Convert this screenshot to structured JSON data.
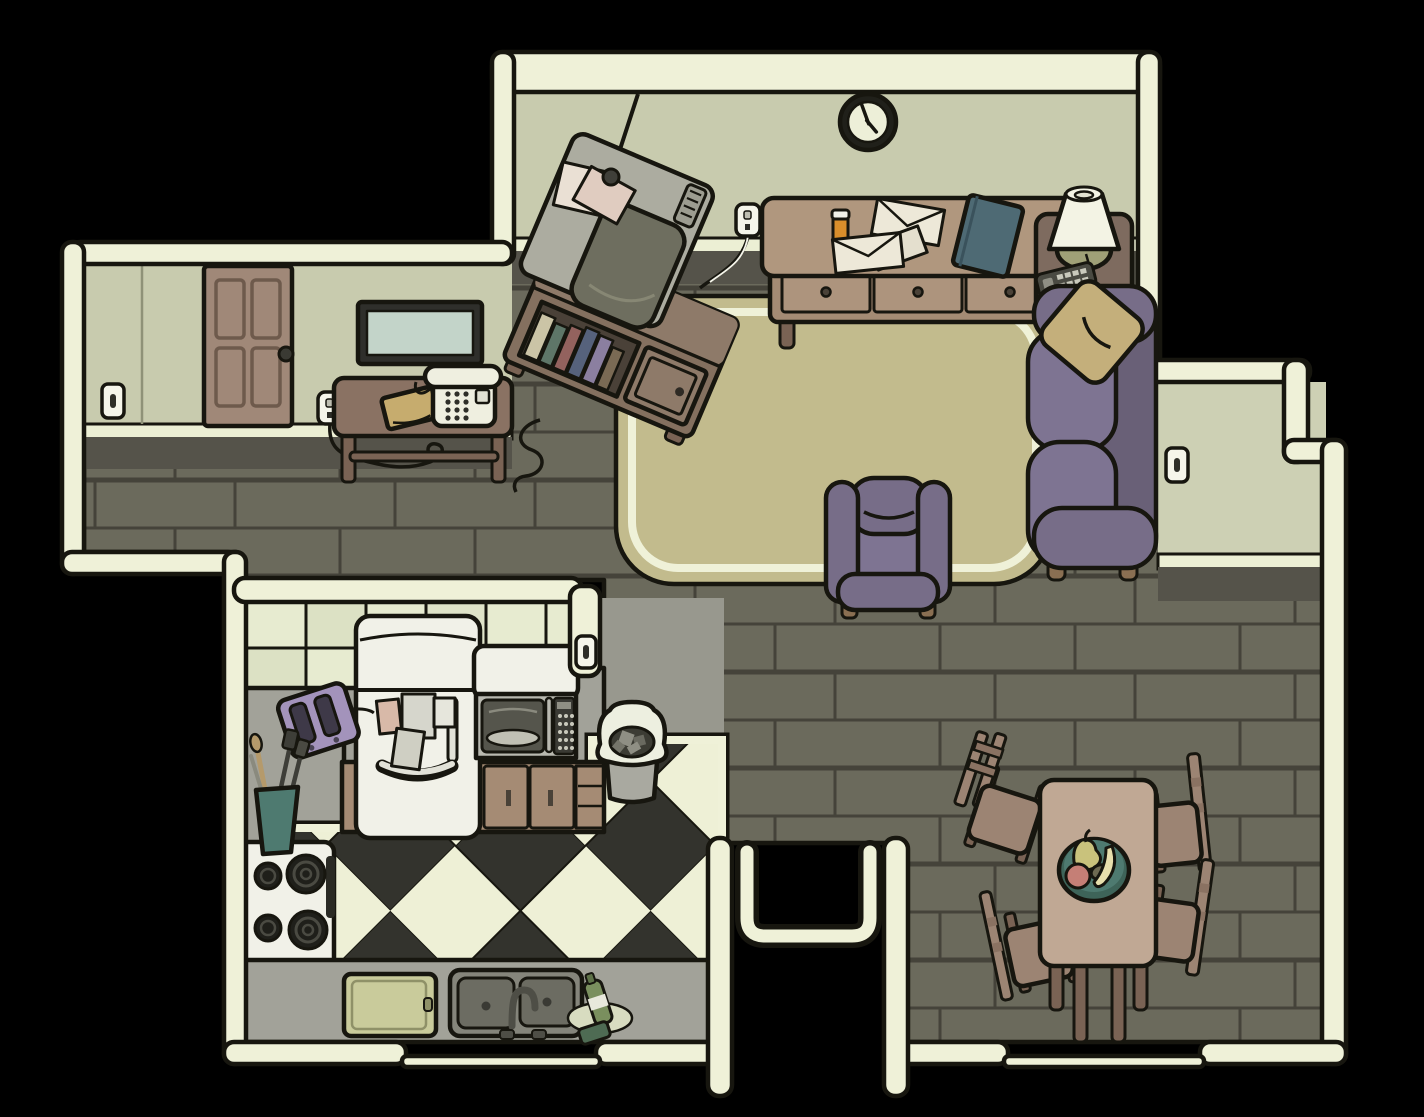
{
  "scene": {
    "title": "Top-down apartment scene",
    "style": "hand-drawn cartoon adventure game",
    "rooms": [
      "living room",
      "hallway",
      "kitchen",
      "dining room"
    ]
  },
  "palette": {
    "background": "#000000",
    "ink": "#17160f",
    "wall_cream": "#EFF1D8",
    "wall_face": "#C8CBAE",
    "wall_face_light": "#CDD0B4",
    "baseboard": "#ECEFD4",
    "shadow_band": "#55534A",
    "wood_floor": "#6B6A5C",
    "plank_line": "#45433A",
    "rug": "#C2BB8D",
    "sofa_purple": "#776D88",
    "sofa_purple_dark": "#696077",
    "sofa_purple_light": "#7E7492",
    "pillow_tan": "#C4AF7B",
    "furniture_brown": "#8A7263",
    "furniture_brown_dark": "#7A6354",
    "sideboard_tan": "#B0977E",
    "tv_gray": "#ACACA0",
    "tv_screen": "#6E6E5F",
    "door_brown": "#A08878",
    "mirror_glass": "#C3D4C9",
    "tile_cream": "#E7EBD0",
    "counter_gray": "#A2A299",
    "appliance_white": "#F1F1E8",
    "cabinet_brown": "#A58B74",
    "checker_dark": "#33332D",
    "checker_light": "#EEF0D6",
    "toaster_purple": "#A393BB",
    "bowl_teal": "#4E7A70",
    "lamp_olive": "#9FA077",
    "book_teal": "#4E6A74",
    "book_tan": "#C6AC6E",
    "pill_orange": "#D98E2B"
  },
  "clock": {
    "time_shown": "approx 4:55",
    "minute_hand_angle_deg": -20,
    "hour_hand_angle_deg": 140
  },
  "objects": {
    "scene_floor": "Wood plank floor",
    "rug": "Living room area rug",
    "clock": "Wall clock",
    "tv": "CRT television",
    "tv_antenna": "TV antenna",
    "tv_papers": "Papers on TV",
    "tv_stand": "TV stand with books",
    "sideboard": "Sideboard with three drawers",
    "pill_bottle": "Pill bottle",
    "envelopes": "Envelopes",
    "blue_book": "Teal book",
    "outlet_tv": "Power outlet",
    "outlet_lamp": "Power outlet",
    "outlet_phone": "Power outlet",
    "side_table": "Side table",
    "lamp": "Table lamp",
    "remote": "TV remote control",
    "sofa": "Purple sofa",
    "pillow": "Throw pillow",
    "armchair": "Purple armchair",
    "door": "Apartment door",
    "mirror": "Wall mirror",
    "light_switch_hall": "Light switch",
    "light_switch_wall": "Light switch",
    "light_switch_kitchen": "Light switch",
    "phone_table": "Telephone table",
    "phone": "Telephone",
    "tan_book": "Book",
    "kitchen_tiles": "Tile backsplash",
    "fridge": "Refrigerator",
    "fridge_notes": "Notes on fridge",
    "microwave": "Microwave oven",
    "toaster": "Toaster",
    "utensils": "Utensil cup",
    "stove": "Electric stove top",
    "cabinets": "Kitchen cabinets",
    "counter": "Kitchen counter",
    "trash": "Trash can",
    "sink": "Double kitchen sink",
    "cutting_board": "Cutting board",
    "soap": "Dish soap and sponge",
    "checker_floor": "Checkered kitchen floor",
    "dining_table": "Dining table",
    "fruit_bowl": "Fruit bowl",
    "chair_1": "Dining chair",
    "chair_2": "Dining chair",
    "chair_3": "Dining chair",
    "chair_4": "Dining chair",
    "passage": "Passage to entry"
  }
}
